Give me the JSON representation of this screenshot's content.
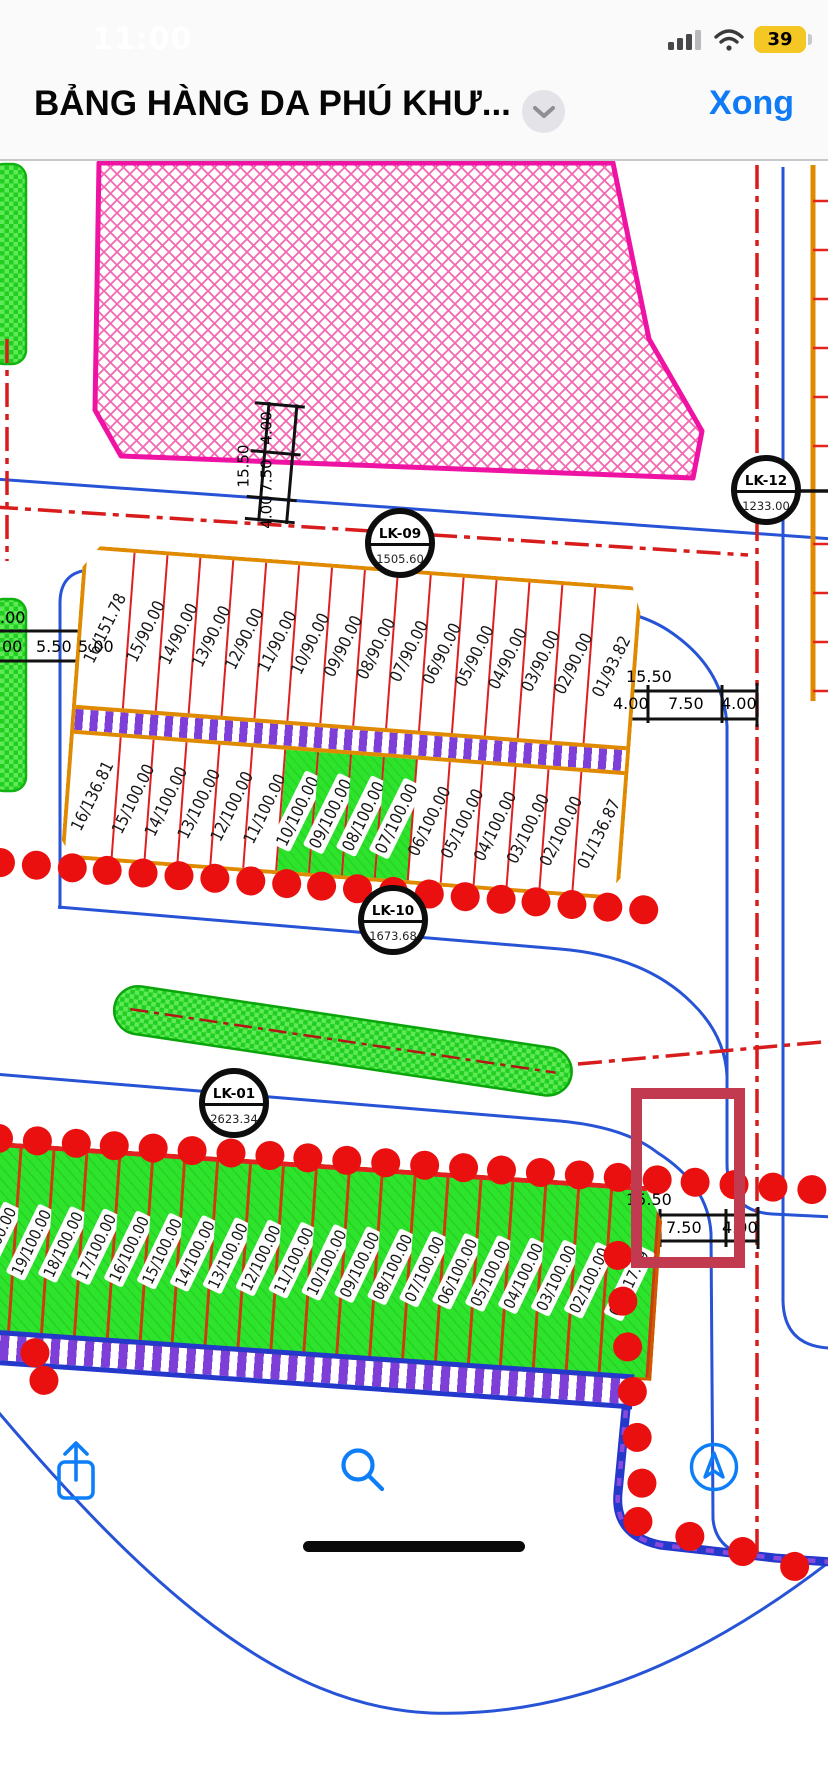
{
  "status_bar": {
    "time": "11:00",
    "battery_level": "39"
  },
  "nav_bar": {
    "title": "BẢNG HÀNG DA PHÚ KHƯ...",
    "done_label": "Xong"
  },
  "map": {
    "blocks": {
      "lk09": {
        "badge": {
          "name": "LK-09",
          "area": "1505.60"
        },
        "plots": [
          "16/151.78",
          "15/90.00",
          "14/90.00",
          "13/90.00",
          "12/90.00",
          "11/90.00",
          "10/90.00",
          "09/90.00",
          "08/90.00",
          "07/90.00",
          "06/90.00",
          "05/90.00",
          "04/90.00",
          "03/90.00",
          "02/90.00",
          "01/93.82"
        ]
      },
      "lk10": {
        "badge": {
          "name": "LK-10",
          "area": "1673.68"
        },
        "plots": [
          {
            "label": "16/136.81"
          },
          {
            "label": "15/100.00"
          },
          {
            "label": "14/100.00"
          },
          {
            "label": "13/100.00"
          },
          {
            "label": "12/100.00"
          },
          {
            "label": "11/100.00"
          },
          {
            "label": "10/100.00",
            "cls": "green"
          },
          {
            "label": "09/100.00",
            "cls": "green"
          },
          {
            "label": "08/100.00",
            "cls": "green"
          },
          {
            "label": "07/100.00",
            "cls": "green"
          },
          {
            "label": "06/100.00"
          },
          {
            "label": "05/100.00"
          },
          {
            "label": "04/100.00"
          },
          {
            "label": "03/100.00"
          },
          {
            "label": "02/100.00"
          },
          {
            "label": "01/136.87"
          }
        ]
      },
      "lk12": {
        "badge": {
          "name": "LK-12",
          "area": "1233.00"
        }
      },
      "lk01": {
        "badge": {
          "name": "LK-01",
          "area": "2623.34"
        },
        "plots": [
          {
            "label": "20/100.00"
          },
          {
            "label": "19/100.00"
          },
          {
            "label": "18/100.00"
          },
          {
            "label": "17/100.00"
          },
          {
            "label": "16/100.00"
          },
          {
            "label": "15/100.00"
          },
          {
            "label": "14/100.00"
          },
          {
            "label": "13/100.00"
          },
          {
            "label": "12/100.00"
          },
          {
            "label": "11/100.00"
          },
          {
            "label": "10/100.00"
          },
          {
            "label": "09/100.00"
          },
          {
            "label": "08/100.00"
          },
          {
            "label": "07/100.00"
          },
          {
            "label": "06/100.00"
          },
          {
            "label": "05/100.00"
          },
          {
            "label": "04/100.00"
          },
          {
            "label": "03/100.00"
          },
          {
            "label": "02/100.00"
          },
          {
            "label": "01/117.09"
          }
        ]
      }
    },
    "dimensions": {
      "ladder": {
        "total": "15.50",
        "seg_top": "4.00",
        "seg_mid": "7.50",
        "seg_bottom": "4.00"
      },
      "left": {
        "partial": ".00",
        "a": "00",
        "b": "5.50",
        "c": "5.00"
      },
      "right": {
        "total": "15.50",
        "s1": "4.00",
        "s2": "7.50",
        "s3": "4.00"
      },
      "bottom": {
        "total": "15.50",
        "s1": "7.50",
        "s2": "4.00"
      }
    }
  },
  "toolbar": {
    "icons": [
      "share-icon",
      "search-icon",
      "location-arrow-icon"
    ]
  },
  "colors": {
    "accent_blue": "#0f7bf6",
    "battery_yellow": "#f5c724",
    "plot_green": "#2ee32c",
    "highlight_red": "#c23a50",
    "hatch_pink": "#ef13a3",
    "road_blue": "#2753d6",
    "centerline_red": "#d81c1c",
    "dot_red": "#ea1010",
    "block_orange": "#e08a00",
    "fence_purple": "#7d3fd8"
  }
}
